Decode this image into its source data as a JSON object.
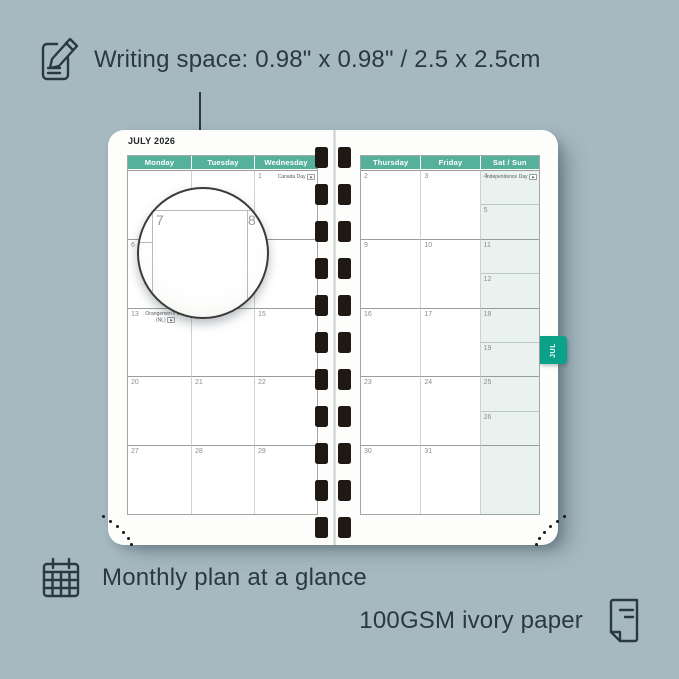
{
  "captions": {
    "writing_space": "Writing space: 0.98\" x 0.98\" / 2.5 x 2.5cm",
    "monthly_plan": "Monthly plan at a glance",
    "paper": "100GSM ivory paper"
  },
  "planner": {
    "month_title": "JULY 2026",
    "tab_label": "JUL",
    "left_page": {
      "headers": [
        "Monday",
        "Tuesday",
        "Wednesday"
      ],
      "rows": [
        [
          {
            "day": ""
          },
          {
            "day": ""
          },
          {
            "day": "1",
            "holiday": "Canada Day",
            "flag": true
          }
        ],
        [
          {
            "day": "6"
          },
          {
            "day": "7"
          },
          {
            "day": "8"
          }
        ],
        [
          {
            "day": "13",
            "holiday": "Orangemen's Day (NL)",
            "flag": true,
            "wrap": true
          },
          {
            "day": "14"
          },
          {
            "day": "15"
          }
        ],
        [
          {
            "day": "20"
          },
          {
            "day": "21"
          },
          {
            "day": "22"
          }
        ],
        [
          {
            "day": "27"
          },
          {
            "day": "28"
          },
          {
            "day": "29"
          }
        ]
      ]
    },
    "right_page": {
      "headers": [
        "Thursday",
        "Friday",
        "Sat / Sun"
      ],
      "rows": [
        {
          "thu": "2",
          "fri": "3",
          "sat": {
            "day": "4",
            "holiday": "Independence Day",
            "flag": true
          },
          "sun": {
            "day": "5"
          }
        },
        {
          "thu": "9",
          "fri": "10",
          "sat": {
            "day": "11"
          },
          "sun": {
            "day": "12"
          }
        },
        {
          "thu": "16",
          "fri": "17",
          "sat": {
            "day": "18"
          },
          "sun": {
            "day": "19"
          }
        },
        {
          "thu": "23",
          "fri": "24",
          "sat": {
            "day": "25"
          },
          "sun": {
            "day": "26"
          }
        },
        {
          "thu": "30",
          "fri": "31",
          "sat": {
            "day": ""
          },
          "sun": null
        }
      ]
    },
    "magnifier": {
      "day": "7",
      "adjacent_day": "8"
    }
  },
  "icons": {
    "flag_glyph": "⚑",
    "note_pencil": "note-pencil-icon",
    "calendar_grid": "calendar-grid-icon",
    "document": "document-icon"
  },
  "colors": {
    "background": "#A6B9C1",
    "header_green": "#56B19C",
    "tab_green": "#0BA289",
    "weekend_mint": "#E9F2EE",
    "page_white": "#FDFDFC",
    "text_dark": "#2C3840"
  }
}
